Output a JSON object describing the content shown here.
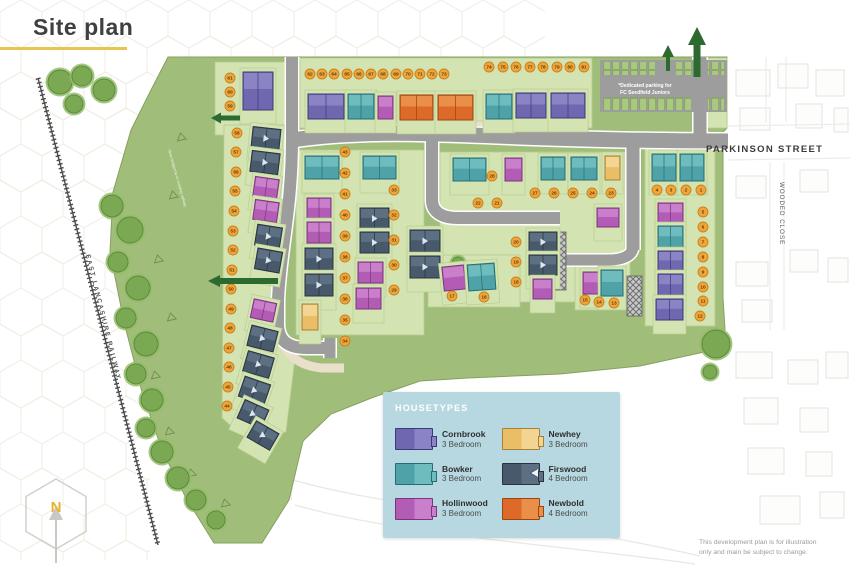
{
  "header": {
    "title": "Site plan"
  },
  "labels": {
    "parkinson_street": "PARKINSON STREET",
    "wooded_close": "WOODED CLOSE",
    "railway": "EAST LANCASHIRE RAILWAY",
    "parking_note_line1": "*Dedicated parking for",
    "parking_note_line2": "FC Seedfield Juniors",
    "hedgerow_note": "New hedgerow to existing railway",
    "compass_n": "N",
    "disclaimer_line1": "This development plan is for illustration",
    "disclaimer_line2": "only and main be subject to change."
  },
  "legend": {
    "title": "HOUSETYPES",
    "items": [
      {
        "name": "Cornbrook",
        "bedrooms": "3 Bedroom",
        "type": "cb"
      },
      {
        "name": "Bowker",
        "bedrooms": "3 Bedroom",
        "type": "bw"
      },
      {
        "name": "Hollinwood",
        "bedrooms": "3 Bedroom",
        "type": "hw"
      },
      {
        "name": "Newhey",
        "bedrooms": "3 Bedroom",
        "type": "nh"
      },
      {
        "name": "Firswood",
        "bedrooms": "4 Bedroom",
        "type": "fw"
      },
      {
        "name": "Newbold",
        "bedrooms": "4 Bedroom",
        "type": "nb"
      }
    ]
  },
  "colors": {
    "accent": "#e5c64f",
    "legend_bg": "#b7d8e0",
    "field": "#a0bd7a",
    "parcel": "#d4e3b2",
    "road": "#9d9d9d",
    "drive": "#e9dfca",
    "plot_circle": "#f0a43a",
    "plot_ring": "#c5841c",
    "arrow_green": "#2d6a30",
    "houses": {
      "cb": {
        "base": "#6f68b0",
        "light": "#8a84c4",
        "border": "#3e3878"
      },
      "bw": {
        "base": "#4fa3a8",
        "light": "#6fbcbe",
        "border": "#266d72"
      },
      "hw": {
        "base": "#b35cb5",
        "light": "#c97fca",
        "border": "#7c347e"
      },
      "nh": {
        "base": "#e9be67",
        "light": "#f2d493",
        "border": "#a8803a"
      },
      "fw": {
        "base": "#48596c",
        "light": "#5d7083",
        "border": "#27333f"
      },
      "nb": {
        "base": "#dd6a28",
        "light": "#e98f49",
        "border": "#99460f"
      }
    }
  },
  "houses": [
    [
      308,
      94,
      36,
      25,
      "cb",
      0
    ],
    [
      348,
      94,
      26,
      25,
      "bw",
      0
    ],
    [
      378,
      96,
      15,
      23,
      "hw",
      0
    ],
    [
      400,
      95,
      33,
      25,
      "nb",
      0
    ],
    [
      438,
      95,
      35,
      25,
      "nb",
      0
    ],
    [
      486,
      94,
      26,
      25,
      "bw",
      0
    ],
    [
      516,
      93,
      30,
      25,
      "cb",
      0
    ],
    [
      551,
      93,
      34,
      25,
      "cb",
      0
    ],
    [
      243,
      72,
      30,
      38,
      "cb",
      0
    ],
    [
      252,
      128,
      28,
      21,
      "fw",
      6
    ],
    [
      251,
      152,
      28,
      21,
      "fw",
      7
    ],
    [
      254,
      178,
      24,
      20,
      "hw",
      8
    ],
    [
      254,
      201,
      24,
      20,
      "hw",
      8
    ],
    [
      256,
      226,
      25,
      21,
      "fw",
      9
    ],
    [
      256,
      250,
      25,
      21,
      "fw",
      10
    ],
    [
      252,
      301,
      23,
      19,
      "hw",
      12
    ],
    [
      249,
      328,
      27,
      21,
      "fw",
      14
    ],
    [
      245,
      354,
      27,
      21,
      "fw",
      16
    ],
    [
      241,
      380,
      27,
      21,
      "fw",
      19
    ],
    [
      240,
      404,
      26,
      20,
      "fw",
      24
    ],
    [
      250,
      426,
      26,
      19,
      "fw",
      30
    ],
    [
      305,
      156,
      34,
      23,
      "bw",
      0
    ],
    [
      307,
      198,
      24,
      21,
      "hw",
      0
    ],
    [
      307,
      222,
      24,
      21,
      "hw",
      0
    ],
    [
      305,
      248,
      28,
      22,
      "fw",
      0
    ],
    [
      305,
      274,
      28,
      22,
      "fw",
      0
    ],
    [
      302,
      304,
      16,
      26,
      "nh",
      0
    ],
    [
      363,
      156,
      33,
      23,
      "bw",
      0
    ],
    [
      360,
      208,
      29,
      21,
      "fw",
      0
    ],
    [
      360,
      232,
      29,
      21,
      "fw",
      0
    ],
    [
      358,
      262,
      25,
      21,
      "hw",
      0
    ],
    [
      356,
      288,
      25,
      21,
      "hw",
      0
    ],
    [
      453,
      158,
      33,
      23,
      "bw",
      0
    ],
    [
      505,
      158,
      17,
      23,
      "hw",
      0
    ],
    [
      541,
      157,
      24,
      23,
      "bw",
      0
    ],
    [
      571,
      157,
      26,
      23,
      "bw",
      0
    ],
    [
      605,
      156,
      15,
      24,
      "nh",
      0
    ],
    [
      410,
      230,
      30,
      22,
      "fw",
      0
    ],
    [
      410,
      256,
      30,
      22,
      "fw",
      0
    ],
    [
      529,
      232,
      28,
      20,
      "fw",
      0
    ],
    [
      529,
      255,
      28,
      20,
      "fw",
      0
    ],
    [
      533,
      279,
      19,
      20,
      "hw",
      0
    ],
    [
      597,
      208,
      22,
      19,
      "hw",
      0
    ],
    [
      443,
      266,
      22,
      24,
      "hw",
      -6
    ],
    [
      468,
      264,
      27,
      26,
      "bw",
      -4
    ],
    [
      583,
      272,
      18,
      22,
      "hw",
      0
    ],
    [
      601,
      270,
      22,
      26,
      "bw",
      0
    ],
    [
      652,
      154,
      24,
      27,
      "bw",
      0
    ],
    [
      680,
      154,
      24,
      27,
      "bw",
      0
    ],
    [
      658,
      203,
      25,
      20,
      "hw",
      0
    ],
    [
      658,
      226,
      25,
      22,
      "bw",
      0
    ],
    [
      658,
      251,
      25,
      20,
      "cb",
      0
    ],
    [
      658,
      274,
      25,
      22,
      "cb",
      0
    ],
    [
      656,
      299,
      27,
      21,
      "cb",
      0
    ]
  ],
  "plots": [
    [
      1,
      701,
      190
    ],
    [
      2,
      686,
      190
    ],
    [
      3,
      671,
      190
    ],
    [
      4,
      657,
      190
    ],
    [
      5,
      703,
      212
    ],
    [
      6,
      703,
      227
    ],
    [
      7,
      703,
      242
    ],
    [
      8,
      703,
      257
    ],
    [
      9,
      703,
      272
    ],
    [
      10,
      703,
      287
    ],
    [
      11,
      703,
      301
    ],
    [
      12,
      700,
      316
    ],
    [
      13,
      614,
      303
    ],
    [
      14,
      599,
      302
    ],
    [
      15,
      585,
      300
    ],
    [
      16,
      484,
      297
    ],
    [
      17,
      452,
      296
    ],
    [
      18,
      516,
      282
    ],
    [
      19,
      516,
      262
    ],
    [
      20,
      516,
      242
    ],
    [
      21,
      497,
      203
    ],
    [
      22,
      478,
      203
    ],
    [
      23,
      611,
      193
    ],
    [
      24,
      592,
      193
    ],
    [
      25,
      573,
      193
    ],
    [
      26,
      554,
      193
    ],
    [
      27,
      535,
      193
    ],
    [
      28,
      492,
      176
    ],
    [
      29,
      394,
      290
    ],
    [
      30,
      394,
      265
    ],
    [
      31,
      394,
      240
    ],
    [
      32,
      394,
      215
    ],
    [
      33,
      394,
      190
    ],
    [
      34,
      345,
      341
    ],
    [
      35,
      345,
      320
    ],
    [
      36,
      345,
      299
    ],
    [
      37,
      345,
      278
    ],
    [
      38,
      345,
      257
    ],
    [
      39,
      345,
      236
    ],
    [
      40,
      345,
      215
    ],
    [
      41,
      345,
      194
    ],
    [
      42,
      345,
      173
    ],
    [
      43,
      345,
      152
    ],
    [
      44,
      227,
      406
    ],
    [
      45,
      228,
      387
    ],
    [
      46,
      229,
      367
    ],
    [
      47,
      229,
      348
    ],
    [
      48,
      230,
      328
    ],
    [
      49,
      231,
      309
    ],
    [
      50,
      231,
      289
    ],
    [
      51,
      232,
      270
    ],
    [
      52,
      233,
      250
    ],
    [
      53,
      233,
      231
    ],
    [
      54,
      234,
      211
    ],
    [
      55,
      235,
      191
    ],
    [
      56,
      236,
      172
    ],
    [
      57,
      236,
      152
    ],
    [
      58,
      237,
      133
    ],
    [
      59,
      230,
      106
    ],
    [
      60,
      230,
      92
    ],
    [
      61,
      230,
      78
    ],
    [
      62,
      310,
      74
    ],
    [
      63,
      322,
      74
    ],
    [
      64,
      334,
      74
    ],
    [
      65,
      347,
      74
    ],
    [
      66,
      359,
      74
    ],
    [
      67,
      371,
      74
    ],
    [
      68,
      383,
      74
    ],
    [
      69,
      396,
      74
    ],
    [
      70,
      408,
      74
    ],
    [
      71,
      420,
      74
    ],
    [
      72,
      432,
      74
    ],
    [
      73,
      444,
      74
    ],
    [
      74,
      489,
      67
    ],
    [
      75,
      503,
      67
    ],
    [
      76,
      516,
      67
    ],
    [
      77,
      530,
      67
    ],
    [
      78,
      543,
      67
    ],
    [
      79,
      557,
      67
    ],
    [
      80,
      570,
      67
    ],
    [
      81,
      584,
      67
    ]
  ],
  "trees": [
    [
      60,
      82,
      12
    ],
    [
      82,
      76,
      10
    ],
    [
      104,
      90,
      11
    ],
    [
      74,
      104,
      9
    ],
    [
      112,
      206,
      11
    ],
    [
      130,
      230,
      13
    ],
    [
      118,
      262,
      10
    ],
    [
      138,
      288,
      12
    ],
    [
      126,
      318,
      10
    ],
    [
      146,
      344,
      12
    ],
    [
      136,
      374,
      10
    ],
    [
      152,
      400,
      11
    ],
    [
      146,
      428,
      9
    ],
    [
      162,
      452,
      11
    ],
    [
      178,
      478,
      11
    ],
    [
      196,
      500,
      10
    ],
    [
      216,
      520,
      9
    ],
    [
      716,
      344,
      14
    ],
    [
      710,
      372,
      7
    ],
    [
      458,
      263,
      6
    ],
    [
      470,
      269,
      4
    ]
  ]
}
